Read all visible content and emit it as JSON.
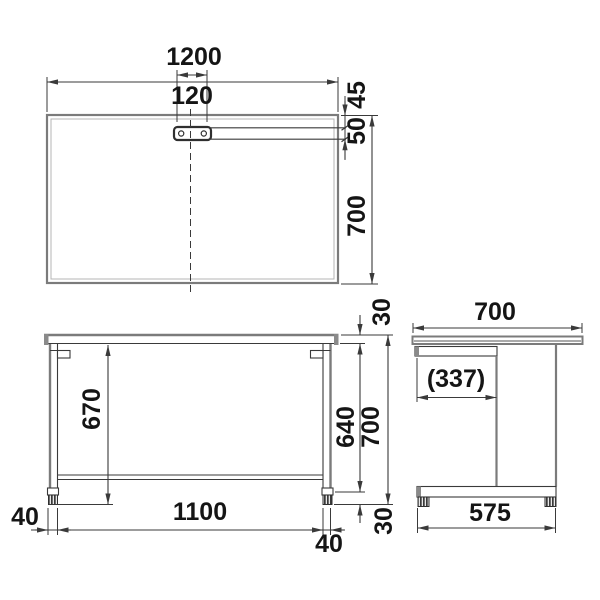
{
  "drawing": {
    "title": "desk-three-view-dimension-drawing",
    "views": {
      "top": {
        "width": "1200",
        "bracket_width": "120",
        "edge_to_bracket": "45",
        "bracket_depth": "50",
        "depth": "700"
      },
      "front": {
        "under_clearance": "670",
        "top_thickness": "30",
        "leg_length": "640",
        "overall_height": "700",
        "leg_width_left": "40",
        "inner_span": "1100",
        "leg_width_right": "40",
        "adjuster_height": "30"
      },
      "side": {
        "depth": "700",
        "knee_clearance": "(337)",
        "foot_depth": "575"
      }
    },
    "colors": {
      "background": "#ffffff",
      "outline": "#7b7b7b",
      "outline_light": "#b4b4b4",
      "dimension_line": "#3a3a3a",
      "text": "#151515",
      "adjuster_fill": "#3a3a3a",
      "endcap_fill": "#8a8a8a"
    }
  }
}
